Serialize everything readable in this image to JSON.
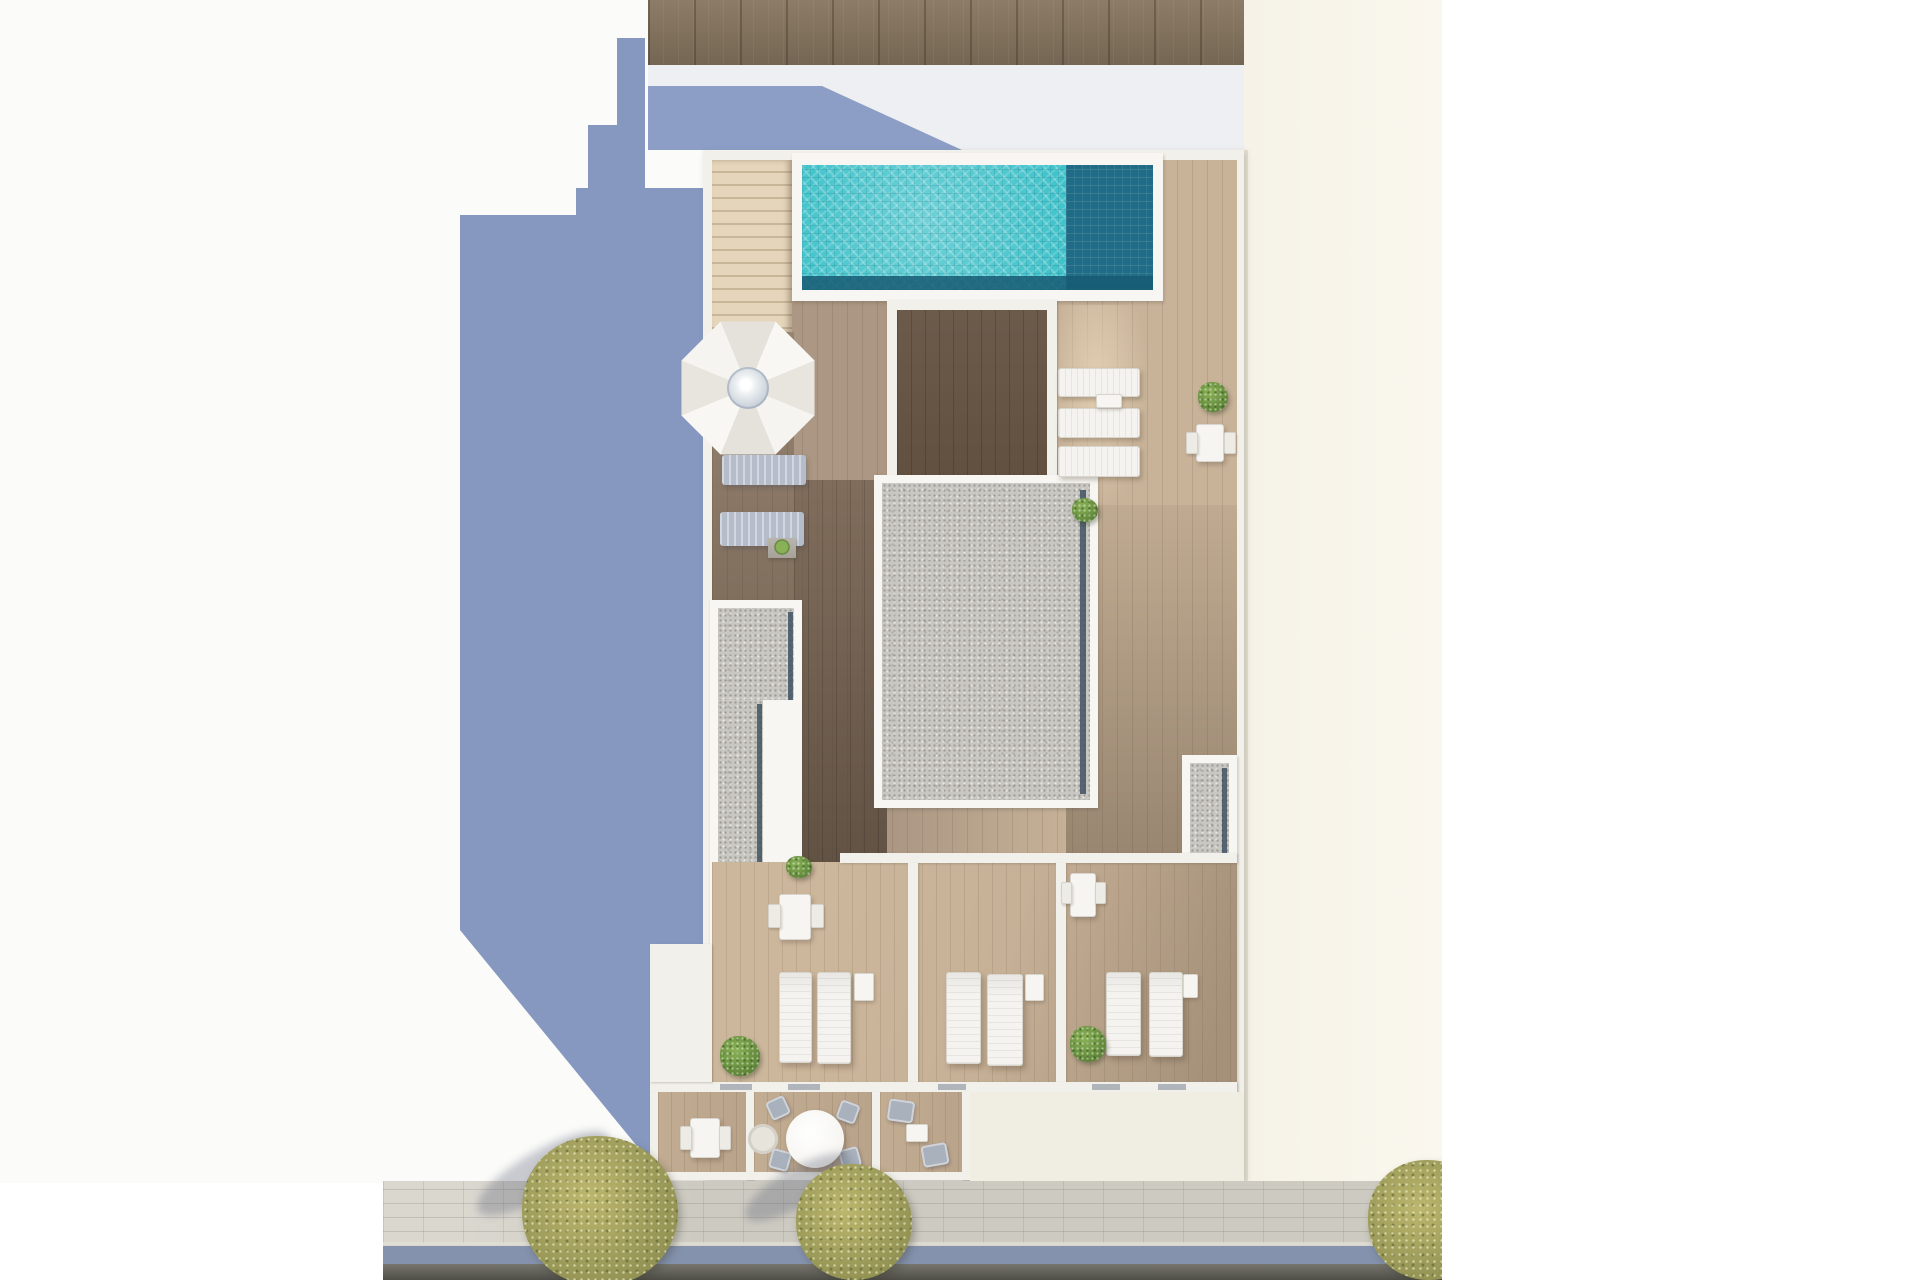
{
  "scene": {
    "kind": "architectural-top-view-render",
    "subject": "rooftop floor plan with swimming pool, sun terraces, private balconies and street"
  },
  "palette": {
    "page-bg": "#ffffff",
    "ground-left": "#fbfbf9",
    "ground-right": "#f6f2e7",
    "ground-right-edge": "#dbd7cb",
    "shadow-blue": "#8698c0",
    "shadow-blue-top": "#8c9ec6",
    "top-band": "#edeff2",
    "roof-wood": "#8d7c67",
    "roof-wood-dark": "#746653",
    "wall": "#f2f0ea",
    "stairs": "#e5d5bb",
    "stairs-line": "#c8b699",
    "deck-top-a": "#ab9783",
    "deck-top-b": "#c8b399",
    "courtyard": "#6c5a4b",
    "sand": "#e2cfb2",
    "terrace": "#c6b096",
    "terrace-dark": "#a5907a",
    "balcony": "#b9a38a",
    "pool-frame": "#f7f6f2",
    "water": "#3fc3cb",
    "water-dark": "#206b86",
    "water-deep": "#175a73",
    "gravel": "#c9c7c2",
    "gutter": "#415263",
    "lounger-white": "#f4f3ef",
    "lounger-gray": "#b5bdca",
    "furn-white": "#f6f5f1",
    "furn-gray": "#a9b1bc",
    "plant-a": "#8ab157",
    "plant-b": "#5a8136",
    "tree-a": "#bcb76e",
    "tree-b": "#8f8f51",
    "sidewalk": "#cdcac1",
    "curb": "#e1ded5",
    "road-stripe": "#8592ae",
    "road-a": "#77766e",
    "road-b": "#4e4d47",
    "ground-bottom": "#f0ede3"
  },
  "objects": [
    {
      "type": "door-mark",
      "name": "door-threshold",
      "x": 720,
      "y": 1084,
      "w": 32,
      "h": 6
    },
    {
      "type": "door-mark",
      "name": "door-threshold",
      "x": 788,
      "y": 1084,
      "w": 32,
      "h": 6
    },
    {
      "type": "door-mark",
      "name": "door-threshold",
      "x": 938,
      "y": 1084,
      "w": 28,
      "h": 6
    },
    {
      "type": "door-mark",
      "name": "door-threshold",
      "x": 1092,
      "y": 1084,
      "w": 28,
      "h": 6
    },
    {
      "type": "door-mark",
      "name": "door-threshold",
      "x": 1158,
      "y": 1084,
      "w": 28,
      "h": 6
    },
    {
      "type": "lounger-gray-h",
      "name": "sun-lounger",
      "x": 722,
      "y": 455,
      "w": 84,
      "h": 30
    },
    {
      "type": "lounger-gray-h",
      "name": "sun-lounger",
      "x": 720,
      "y": 512,
      "w": 84,
      "h": 34
    },
    {
      "type": "planter",
      "name": "planter-box",
      "x": 768,
      "y": 538,
      "w": 28,
      "h": 20
    },
    {
      "type": "lounger-white-h",
      "name": "sun-lounger",
      "x": 1058,
      "y": 368,
      "w": 80,
      "h": 27
    },
    {
      "type": "lounger-white-h",
      "name": "sun-lounger",
      "x": 1058,
      "y": 408,
      "w": 80,
      "h": 28
    },
    {
      "type": "lounger-white-h",
      "name": "sun-lounger",
      "x": 1058,
      "y": 446,
      "w": 80,
      "h": 29
    },
    {
      "type": "side-table",
      "name": "side-table",
      "x": 1096,
      "y": 394,
      "w": 24,
      "h": 12
    },
    {
      "type": "plant",
      "name": "potted-plant",
      "x": 1198,
      "y": 382,
      "w": 30,
      "h": 30
    },
    {
      "type": "table-white",
      "name": "dining-table",
      "x": 1196,
      "y": 424,
      "w": 26,
      "h": 36
    },
    {
      "type": "chair-white",
      "name": "chair",
      "x": 1186,
      "y": 432,
      "w": 10,
      "h": 20
    },
    {
      "type": "chair-white",
      "name": "chair",
      "x": 1224,
      "y": 432,
      "w": 10,
      "h": 20
    },
    {
      "type": "plant",
      "name": "potted-plant",
      "x": 1072,
      "y": 498,
      "w": 26,
      "h": 24
    },
    {
      "type": "plant",
      "name": "potted-plant",
      "x": 786,
      "y": 856,
      "w": 26,
      "h": 22
    },
    {
      "type": "table-white",
      "name": "dining-table",
      "x": 779,
      "y": 894,
      "w": 30,
      "h": 44
    },
    {
      "type": "chair-white",
      "name": "chair",
      "x": 768,
      "y": 904,
      "w": 11,
      "h": 22
    },
    {
      "type": "chair-white",
      "name": "chair",
      "x": 811,
      "y": 904,
      "w": 11,
      "h": 22
    },
    {
      "type": "lounger-white-v",
      "name": "sun-lounger",
      "x": 779,
      "y": 972,
      "w": 31,
      "h": 89
    },
    {
      "type": "lounger-white-v",
      "name": "sun-lounger",
      "x": 817,
      "y": 972,
      "w": 32,
      "h": 90
    },
    {
      "type": "side-table",
      "name": "side-table",
      "x": 854,
      "y": 973,
      "w": 18,
      "h": 26
    },
    {
      "type": "plant",
      "name": "potted-plant",
      "x": 720,
      "y": 1036,
      "w": 40,
      "h": 40
    },
    {
      "type": "lounger-white-v",
      "name": "sun-lounger",
      "x": 946,
      "y": 972,
      "w": 33,
      "h": 90
    },
    {
      "type": "lounger-white-v",
      "name": "sun-lounger",
      "x": 987,
      "y": 974,
      "w": 34,
      "h": 90
    },
    {
      "type": "side-table",
      "name": "side-table",
      "x": 1025,
      "y": 974,
      "w": 17,
      "h": 25
    },
    {
      "type": "table-white",
      "name": "dining-table",
      "x": 1070,
      "y": 873,
      "w": 24,
      "h": 42
    },
    {
      "type": "chair-white",
      "name": "chair",
      "x": 1061,
      "y": 882,
      "w": 9,
      "h": 20
    },
    {
      "type": "chair-white",
      "name": "chair",
      "x": 1095,
      "y": 882,
      "w": 9,
      "h": 20
    },
    {
      "type": "lounger-white-v",
      "name": "sun-lounger",
      "x": 1106,
      "y": 972,
      "w": 33,
      "h": 82
    },
    {
      "type": "lounger-white-v",
      "name": "sun-lounger",
      "x": 1149,
      "y": 972,
      "w": 32,
      "h": 83
    },
    {
      "type": "side-table",
      "name": "side-table",
      "x": 1183,
      "y": 974,
      "w": 13,
      "h": 22
    },
    {
      "type": "plant",
      "name": "potted-plant",
      "x": 1070,
      "y": 1026,
      "w": 36,
      "h": 36
    },
    {
      "type": "table-white",
      "name": "dining-table",
      "x": 690,
      "y": 1118,
      "w": 28,
      "h": 38
    },
    {
      "type": "chair-white",
      "name": "chair",
      "x": 680,
      "y": 1126,
      "w": 10,
      "h": 22
    },
    {
      "type": "chair-white",
      "name": "chair",
      "x": 719,
      "y": 1126,
      "w": 10,
      "h": 22
    },
    {
      "type": "mat-circle",
      "name": "round-mat",
      "x": 748,
      "y": 1124,
      "w": 30,
      "h": 30
    },
    {
      "type": "chair-gray",
      "name": "chair",
      "x": 768,
      "y": 1098,
      "w": 20,
      "h": 20,
      "rot": -25
    },
    {
      "type": "chair-gray",
      "name": "chair",
      "x": 838,
      "y": 1102,
      "w": 20,
      "h": 20,
      "rot": 20
    },
    {
      "type": "chair-gray",
      "name": "chair",
      "x": 770,
      "y": 1150,
      "w": 20,
      "h": 20,
      "rot": 15
    },
    {
      "type": "chair-gray",
      "name": "chair",
      "x": 840,
      "y": 1148,
      "w": 20,
      "h": 20,
      "rot": -15
    },
    {
      "type": "round-table",
      "name": "round-dining-table",
      "x": 786,
      "y": 1110,
      "w": 58,
      "h": 58
    },
    {
      "type": "chair-gray",
      "name": "armchair",
      "x": 888,
      "y": 1100,
      "w": 26,
      "h": 22,
      "rot": 8
    },
    {
      "type": "chair-gray",
      "name": "armchair",
      "x": 922,
      "y": 1144,
      "w": 26,
      "h": 22,
      "rot": -10
    },
    {
      "type": "side-table",
      "name": "coffee-table",
      "x": 906,
      "y": 1124,
      "w": 20,
      "h": 16
    },
    {
      "type": "umbrella",
      "name": "parasol",
      "x": 676,
      "y": 316,
      "w": 144,
      "h": 144
    },
    {
      "type": "tree-shadow",
      "name": "tree-shadow",
      "x": 468,
      "y": 1150,
      "w": 150,
      "h": 46,
      "rot": -30
    },
    {
      "type": "tree-shadow",
      "name": "tree-shadow",
      "x": 738,
      "y": 1168,
      "w": 120,
      "h": 38,
      "rot": -30
    },
    {
      "type": "tree",
      "name": "street-tree",
      "x": 522,
      "y": 1136,
      "w": 156,
      "h": 150
    },
    {
      "type": "tree",
      "name": "street-tree",
      "x": 796,
      "y": 1164,
      "w": 116,
      "h": 116
    },
    {
      "type": "tree",
      "name": "street-tree",
      "x": 1368,
      "y": 1160,
      "w": 122,
      "h": 120
    }
  ]
}
